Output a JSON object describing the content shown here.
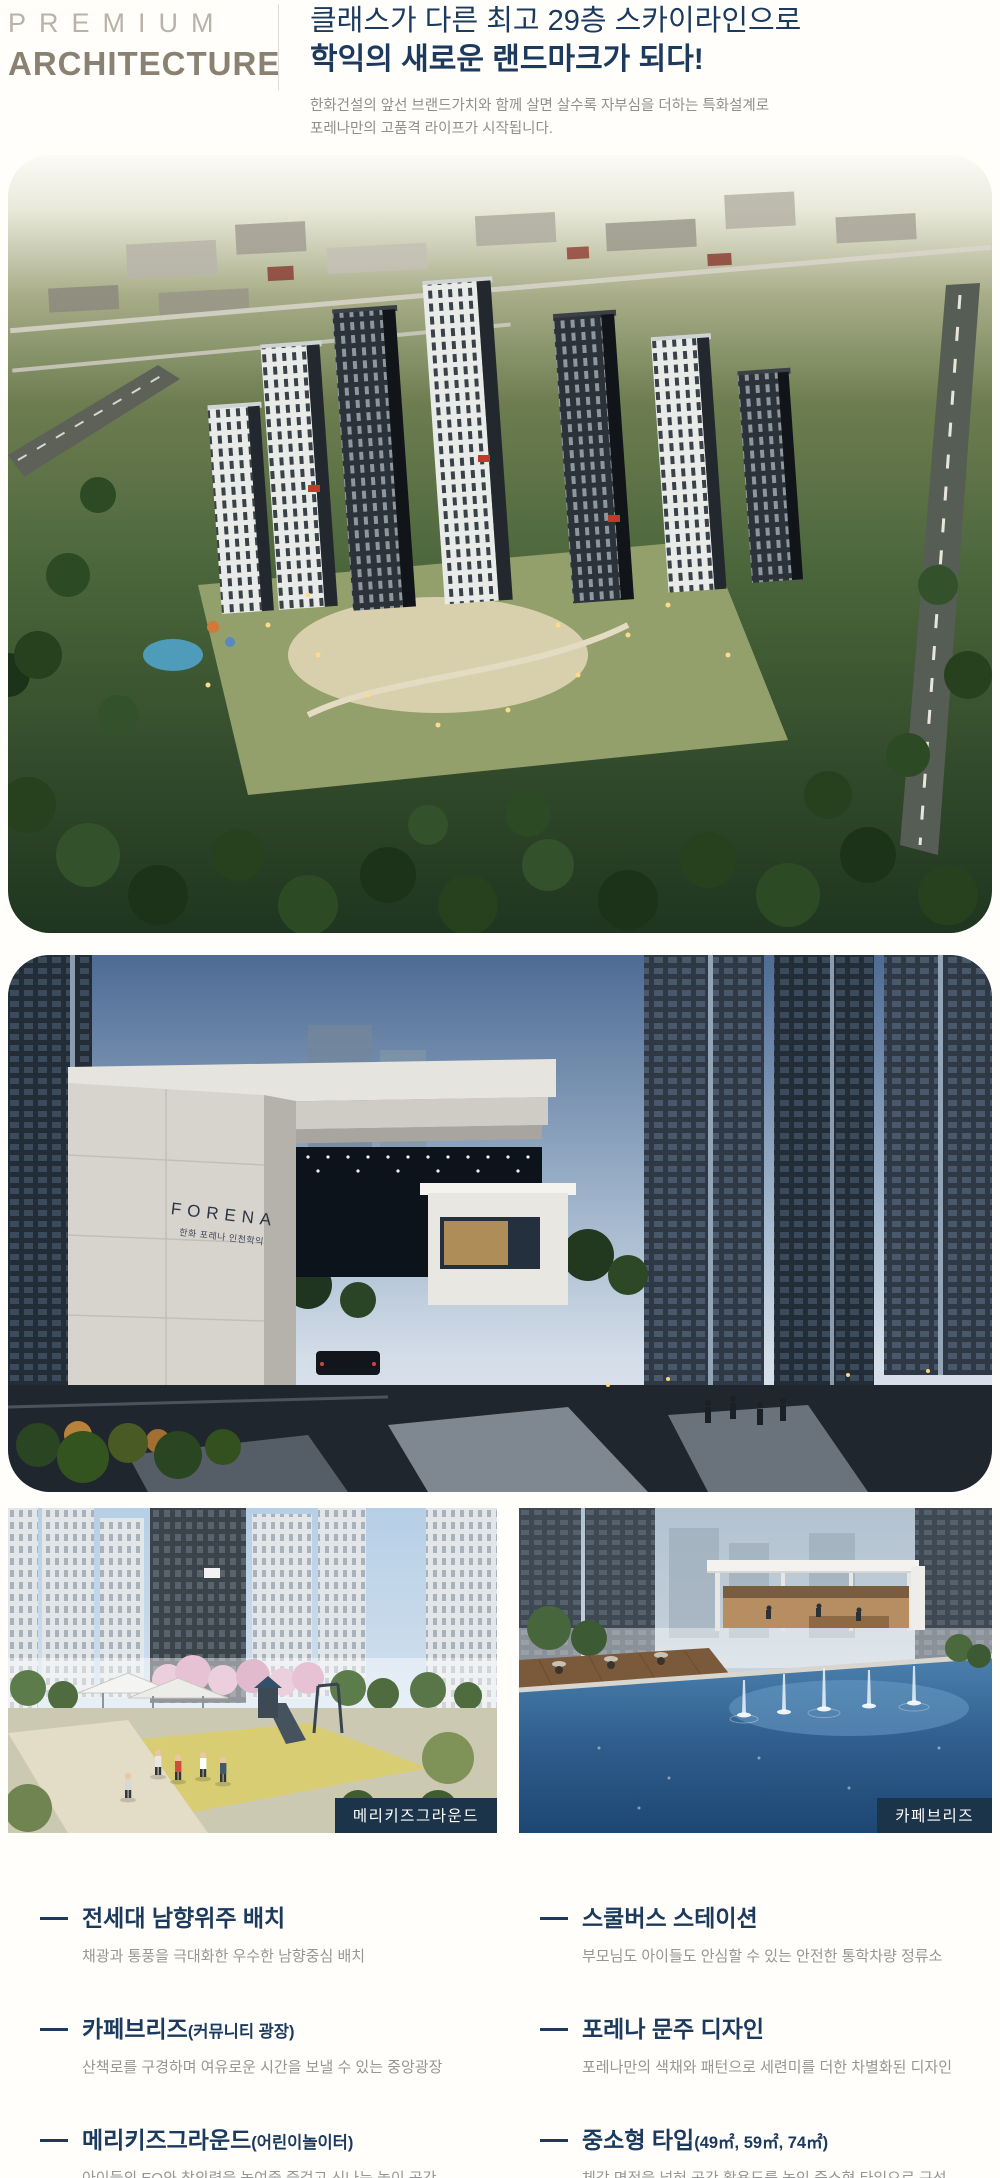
{
  "header": {
    "eyebrow": "PREMIUM",
    "title": "ARCHITECTURE",
    "headline_line1": "클래스가 다른 최고 29층 스카이라인으로",
    "headline_line2": "학익의 새로운 랜드마크가 되다!",
    "desc_line1": "한화건설의 앞선 브랜드가치와 함께 살면 살수록 자부심을 더하는 특화설계로",
    "desc_line2": "포레나만의 고품격 라이프가 시작됩니다."
  },
  "gate_sign": {
    "en": "FORENA",
    "ko": "한화 포레나 인천학익"
  },
  "photo_labels": {
    "playground": "메리키즈그라운드",
    "cafe": "카페브리즈"
  },
  "features": [
    {
      "title": "전세대 남향위주 배치",
      "suffix": "",
      "desc": "채광과 통풍을 극대화한 우수한 남향중심 배치"
    },
    {
      "title": "스쿨버스 스테이션",
      "suffix": "",
      "desc": "부모님도 아이들도 안심할 수 있는 안전한 통학차량 정류소"
    },
    {
      "title": "카페브리즈",
      "suffix": "(커뮤니티 광장)",
      "desc": "산책로를 구경하며 여유로운 시간을 보낼 수 있는 중앙광장"
    },
    {
      "title": "포레나 문주 디자인",
      "suffix": "",
      "desc": "포레나만의 색채와 패턴으로 세련미를 더한 차별화된 디자인"
    },
    {
      "title": "메리키즈그라운드",
      "suffix": "(어린이놀이터)",
      "desc": "아이들의 EQ와 창의력을 높여줄 즐겁고 신나는 놀이 공간"
    },
    {
      "title": "중소형 타입",
      "suffix": "(49㎡, 59㎡, 74㎡)",
      "desc": "체감 면적을 넓혀 공간 활용도를 높인 중소형 타입으로 구성"
    }
  ],
  "colors": {
    "headline_navy": "#1b3a5e",
    "eyebrow_gray": "#b9b2a8",
    "title_taupe": "#8a8173",
    "desc_gray": "#8f8f8f",
    "label_navy": "#1c3449"
  }
}
